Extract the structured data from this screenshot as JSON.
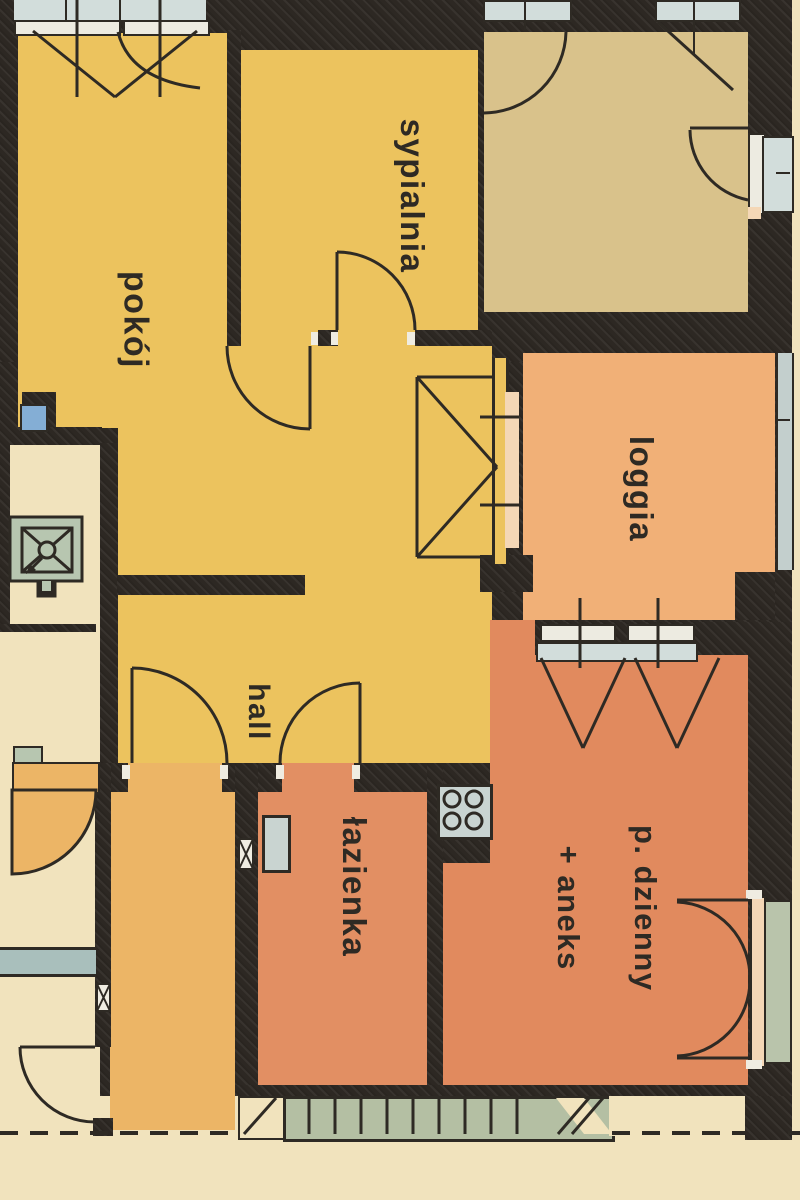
{
  "plan_title": "apartment floor plan",
  "rooms": {
    "pokoj": {
      "label": "pokój"
    },
    "sypialnia": {
      "label": "sypialnia"
    },
    "loggia": {
      "label": "loggia"
    },
    "hall": {
      "label": "hall"
    },
    "lazienka": {
      "label": "łazienka"
    },
    "living": {
      "label_line1": "p. dzienny",
      "label_line2": "+ aneks"
    }
  },
  "colors": {
    "wall": "#2d2823",
    "paper": "#f1e3bd",
    "yellow": "#ecc35e",
    "tan": "#d9c28b",
    "loggiacol": "#f1b077",
    "salmon": "#e18a5e",
    "bathroom": "#e28f63",
    "vestibule": "#ecb566",
    "glass": "#d2dddb",
    "frame": "#edebe1",
    "sill": "#f4d7b6",
    "sage": "#b7c6b0",
    "stairs": "#b4bfa3",
    "blue": "#84aed5",
    "glassdoor": "#b9c4ab",
    "line": "#2e2a24"
  }
}
